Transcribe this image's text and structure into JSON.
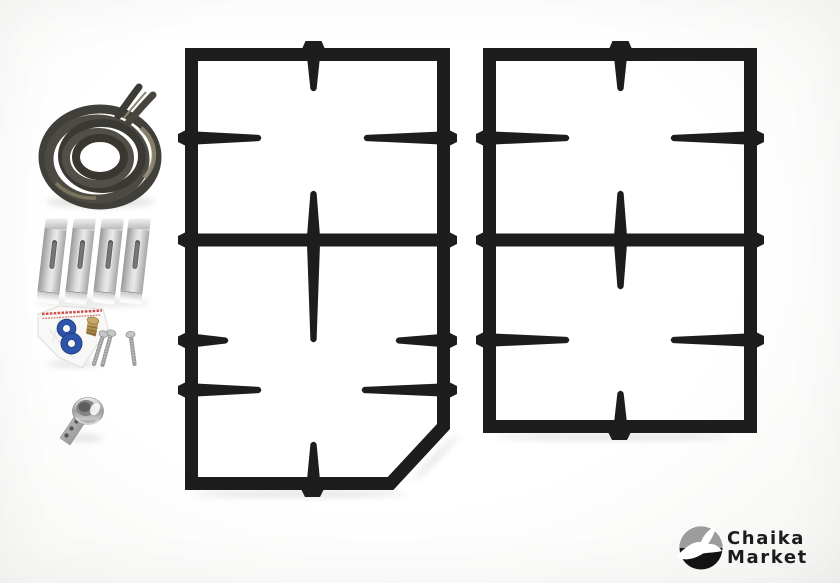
{
  "logo": {
    "icon": "seagull-in-circle",
    "brand_line1": "Chaika",
    "brand_line2": "Market"
  },
  "scene": {
    "description": "Product photo of a gas stove spare-parts set: two black cast-iron two-burner pan-support grates (left one with a cut corner), a coiled door gasket, four metal mounting brackets, a plastic parts bag with two blue washers and a brass fitting, three screws, and a small chrome burner part",
    "items": [
      {
        "name": "gasket-coil",
        "count": 1
      },
      {
        "name": "mounting-bracket",
        "count": 4
      },
      {
        "name": "parts-bag",
        "count": 1
      },
      {
        "name": "blue-washer",
        "count": 2
      },
      {
        "name": "brass-fitting",
        "count": 1
      },
      {
        "name": "screw",
        "count": 3
      },
      {
        "name": "chrome-part",
        "count": 1
      },
      {
        "name": "pan-support-grate",
        "count": 2
      }
    ]
  },
  "colors": {
    "grate": "#1d1d1d",
    "gasket-dark": "#413f39",
    "gasket-tan": "#8f8670",
    "bracket-light": "#dcdcdc",
    "bracket-mid": "#a5a5a5",
    "bag-red": "#cd4a48",
    "washer-blue": "#2d54ab",
    "brass": "#b08e51",
    "screw": "#9d9d9d",
    "logo-black": "#131313",
    "logo-gray": "#9c9c9c",
    "text-dark": "#1c1c1c"
  }
}
